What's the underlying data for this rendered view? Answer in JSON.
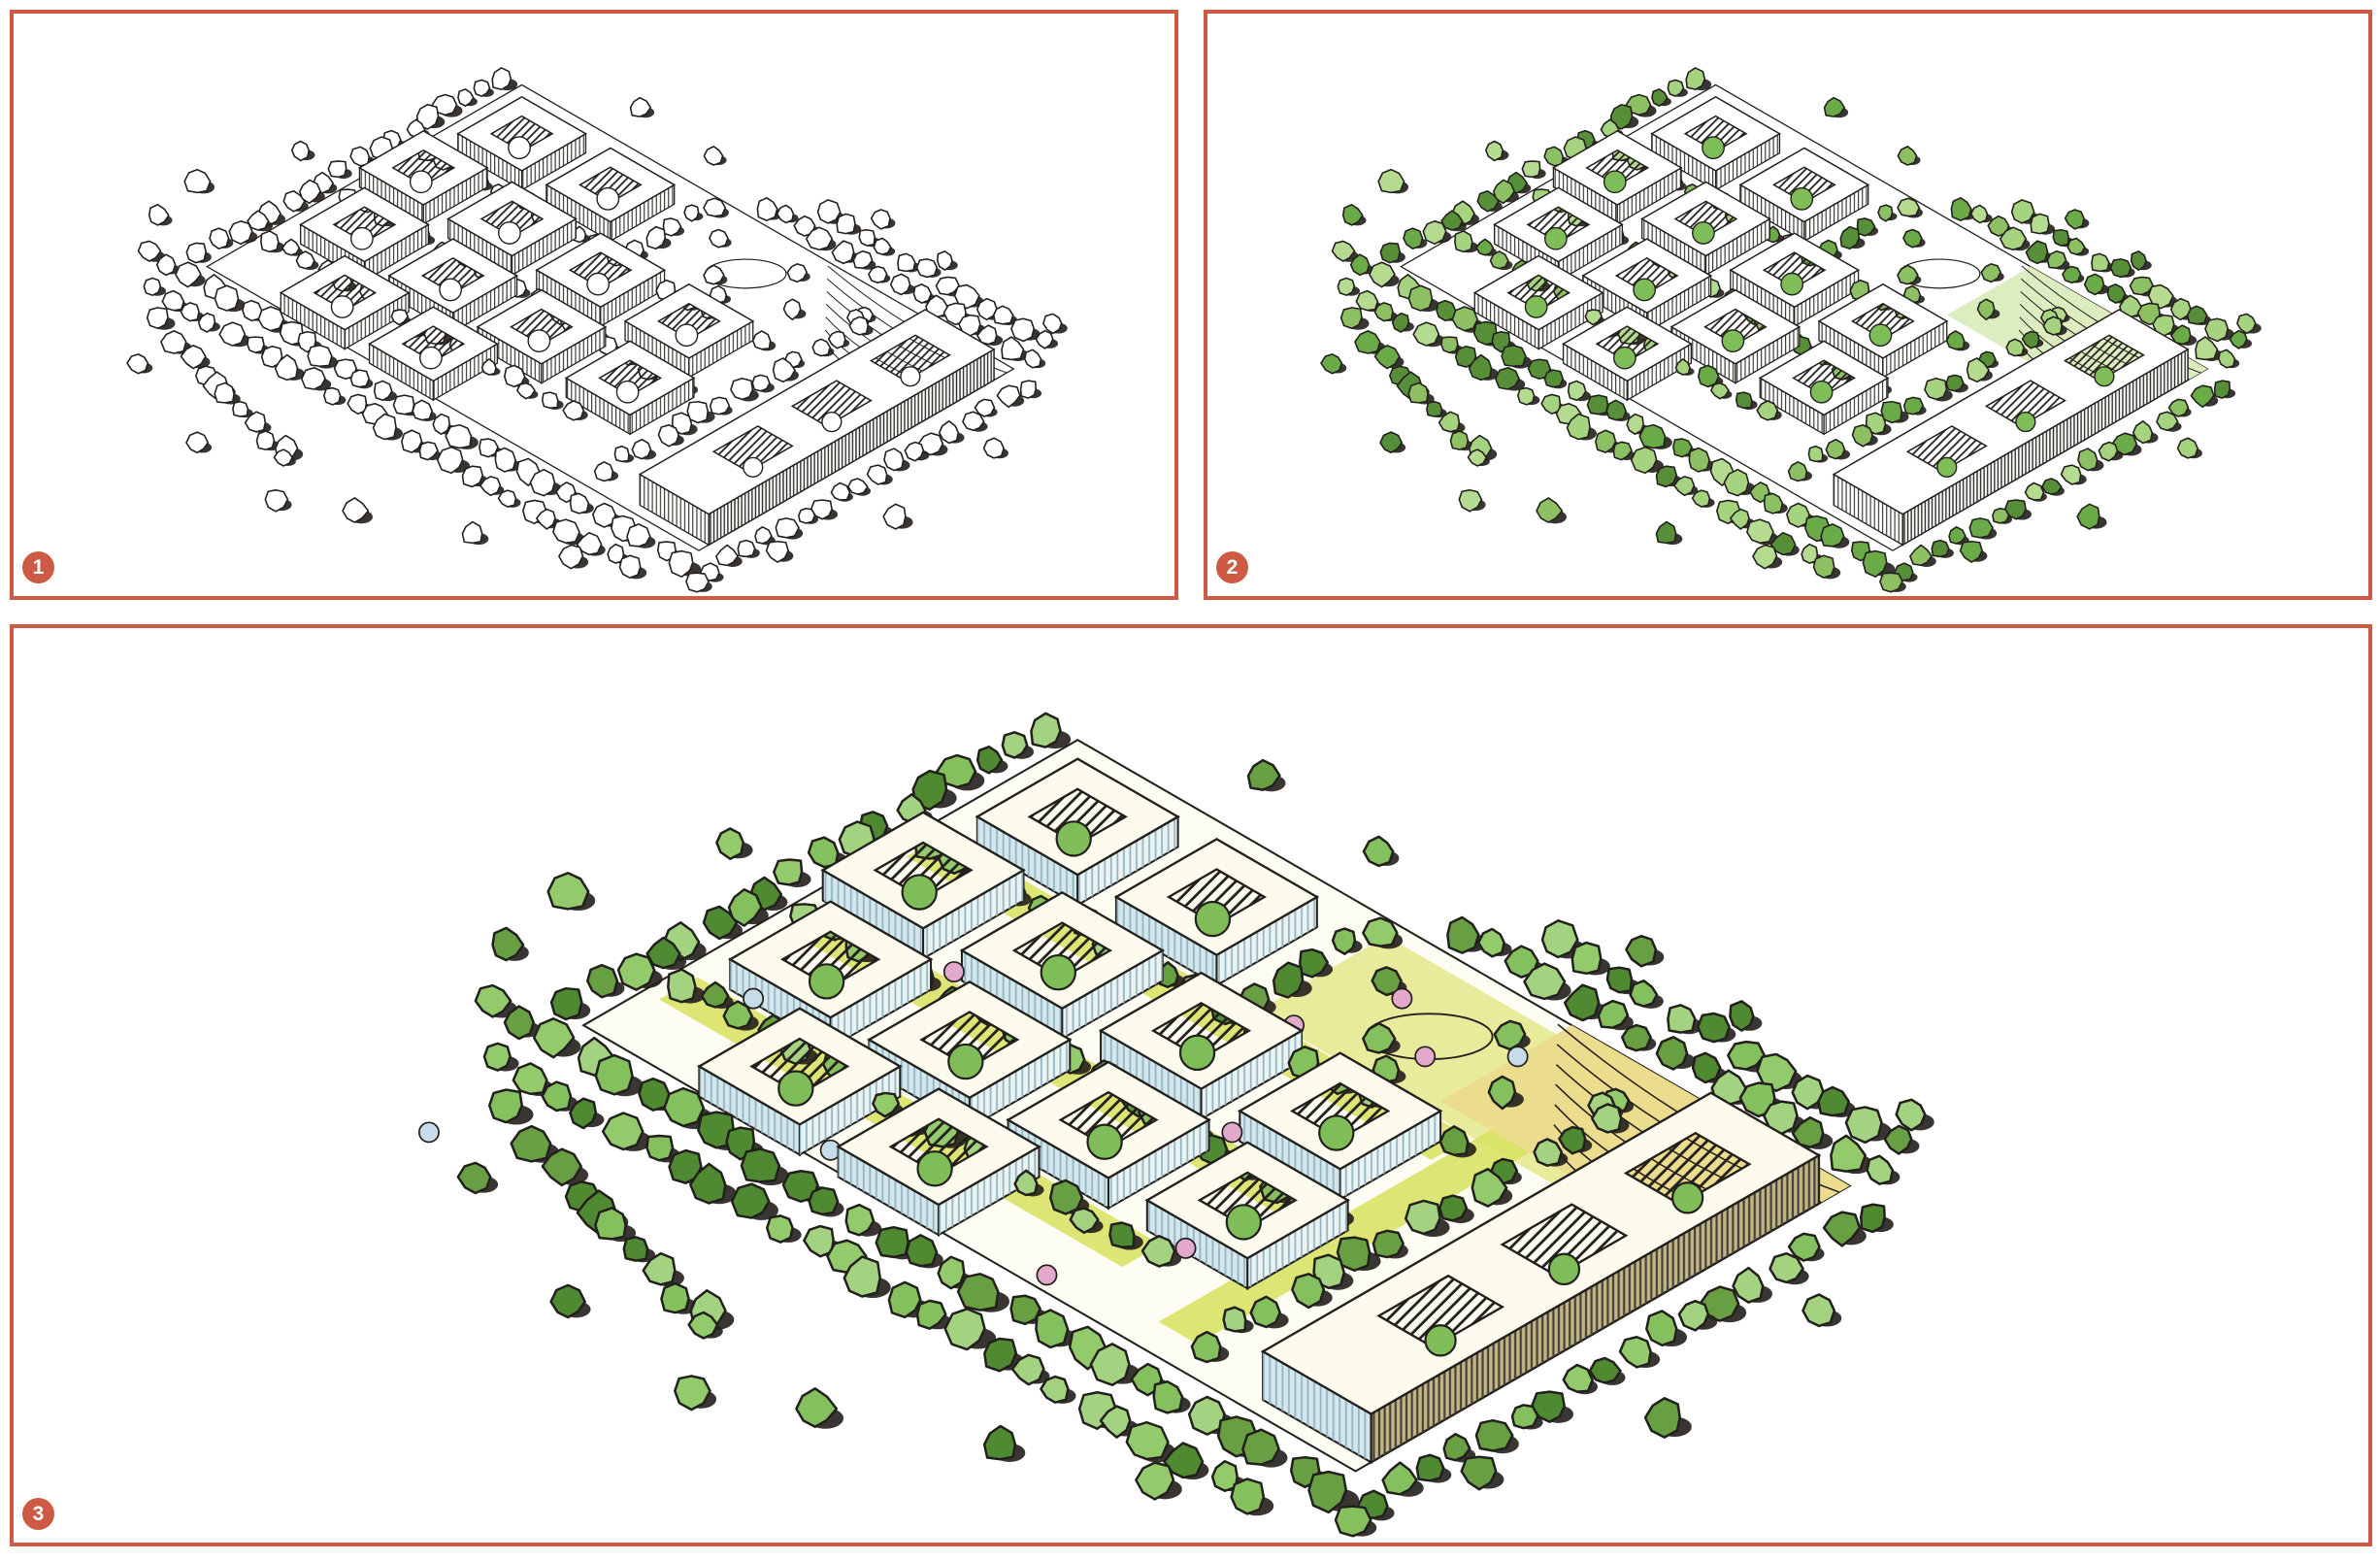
{
  "figure": {
    "accent_color": "#cd5b43",
    "ink_color": "#231f1c",
    "paper_color": "#ffffff",
    "panels": [
      {
        "id": "stage-1",
        "badge": "1",
        "palette": {
          "ground": "#ffffff",
          "roof": "#ffffff",
          "facade_sw": "#ffffff",
          "facade_se": "#ffffff",
          "slab_wall": "#ffffff",
          "stripe": "#2e2a25",
          "slab_stripe": "#2e2a25",
          "trees": [
            "#ffffff"
          ],
          "courtyard_tree": "#ffffff",
          "terrace": "none",
          "park": "none",
          "path": "none",
          "accents": []
        }
      },
      {
        "id": "stage-2",
        "badge": "2",
        "palette": {
          "ground": "#ffffff",
          "roof": "#ffffff",
          "facade_sw": "#ffffff",
          "facade_se": "#ffffff",
          "slab_wall": "#ffffff",
          "stripe": "#2e2a25",
          "slab_stripe": "#2e2a25",
          "trees": [
            "#8cc063",
            "#a5d37f",
            "#6aaa47",
            "#b4db90",
            "#578f38"
          ],
          "courtyard_tree": "#7fbd58",
          "terrace": "#dcedc0",
          "park": "none",
          "path": "none",
          "accents": []
        }
      },
      {
        "id": "stage-3",
        "badge": "3",
        "palette": {
          "ground": "#fdfdf3",
          "roof": "#fcfbee",
          "facade_sw": "#d2e6ec",
          "facade_se": "#ebf3f2",
          "slab_wall": "#c2b584",
          "stripe": "#8fb3c0",
          "slab_stripe": "#45403a",
          "trees": [
            "#85c05e",
            "#a3d381",
            "#679f42",
            "#93ca6b",
            "#4f8a33"
          ],
          "courtyard_tree": "#7fbd58",
          "terrace": "#ecdd8e",
          "park": "#e9eb9c",
          "path": "#d9e266",
          "accents": [
            "#e2a9cc",
            "#c6dcea"
          ]
        }
      }
    ]
  }
}
